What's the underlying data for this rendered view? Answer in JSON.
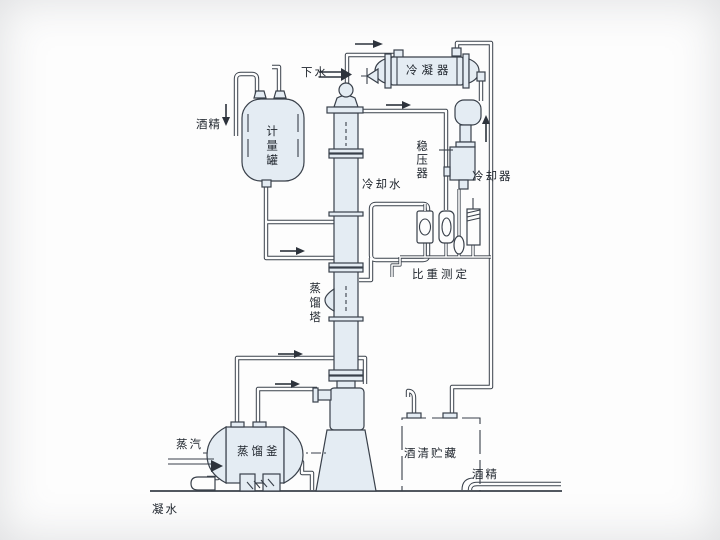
{
  "diagram": {
    "type": "process-flow-diagram",
    "subject": "alcohol distillation system",
    "labels": {
      "drain_water": "下水",
      "condenser": "冷凝器",
      "alcohol_feed": "酒精",
      "metering_tank": "计量罐",
      "pressure_stabilizer": "稳压器",
      "cooling_water": "冷却水",
      "cooler": "冷却器",
      "specific_gravity_measurement": "比重测定",
      "distillation_tower": "蒸馏塔",
      "distillation_kettle": "蒸馏釜",
      "steam": "蒸汽",
      "alcohol_storage": "酒清贮藏",
      "alcohol_out": "酒精",
      "condensate_water": "凝水"
    },
    "colors": {
      "line": "#39404a",
      "vessel_fill": "#e4ecf3",
      "background": "#fdfdfd"
    }
  }
}
